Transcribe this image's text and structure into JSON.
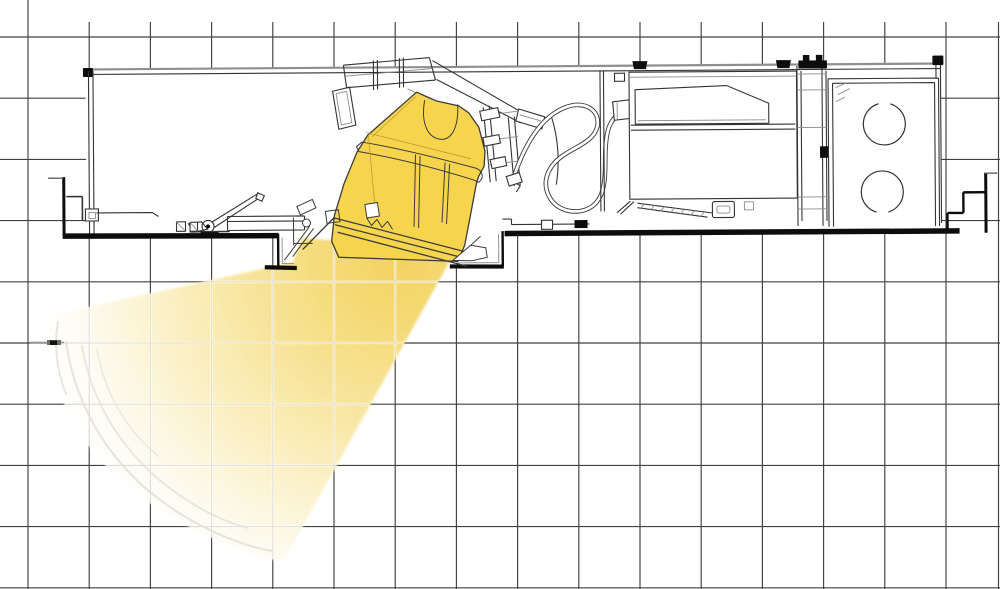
{
  "figure": {
    "title": "Cross-section technical line drawing of a recessed adjustable accent luminaire mounted above a ceiling, projecting a light beam down and to the left, drawn over a square reference grid",
    "type": "technical-line-drawing",
    "visible_text": []
  },
  "grid": {
    "spacing_px": 61.2,
    "offset_x": 28,
    "offset_y": 37,
    "cols": 16,
    "rows": 10,
    "vertical_line_top_y": 22,
    "right_edge_line_x": 998.5,
    "line_color": "#404040",
    "halo_color": "#ffffff"
  },
  "colors": {
    "paper": "#ffffff",
    "ink": "#333333",
    "ink_heavy": "#0d0d0d",
    "ink_light": "#8a8a8a",
    "lamp_yellow": "#f6d44e",
    "lamp_outline": "#3b3b3b",
    "beam_contour": "#e4e1d7"
  },
  "beam": {
    "direction": "down-left",
    "gradient_center": {
      "x": 400,
      "y": 255,
      "r": 370
    },
    "gradient_stops": [
      {
        "offset": 0,
        "color": "#f2d15a",
        "opacity": 0.97
      },
      {
        "offset": 0.22,
        "color": "#f4d973",
        "opacity": 0.95
      },
      {
        "offset": 0.5,
        "color": "#f8e7a2",
        "opacity": 0.9
      },
      {
        "offset": 0.72,
        "color": "#fbf2cc",
        "opacity": 0.86
      },
      {
        "offset": 0.88,
        "color": "#fdfaee",
        "opacity": 0.8
      },
      {
        "offset": 1,
        "color": "#ffffff",
        "opacity": 0.55
      }
    ]
  },
  "components": [
    {
      "id": "grid",
      "label": "Square reference grid"
    },
    {
      "id": "housing-shell",
      "label": "Recessed housing shell"
    },
    {
      "id": "wall-bracket-left",
      "label": "Left ceiling wall bracket"
    },
    {
      "id": "wall-bracket-right",
      "label": "Right ceiling wall bracket"
    },
    {
      "id": "ceiling-line",
      "label": "Thick ceiling line"
    },
    {
      "id": "mounting-frame",
      "label": "Tilted mounting yoke frame"
    },
    {
      "id": "lamp-assembly",
      "label": "Aimable lamp, tilted toward lower-left"
    },
    {
      "id": "aiming-bracket",
      "label": "Aiming slide bracket"
    },
    {
      "id": "adjustment-latch",
      "label": "Locking lever and slide rail"
    },
    {
      "id": "aperture-recess",
      "label": "Aperture trim recess"
    },
    {
      "id": "flex-conduit",
      "label": "Flexible conduit loop"
    },
    {
      "id": "junction-box",
      "label": "Junction box with cover"
    },
    {
      "id": "wiring-raceway",
      "label": "Wiring raceway ladder"
    },
    {
      "id": "end-compartment",
      "label": "End compartment with two knockout circles"
    },
    {
      "id": "light-beam",
      "label": "Projected light beam fan"
    }
  ]
}
